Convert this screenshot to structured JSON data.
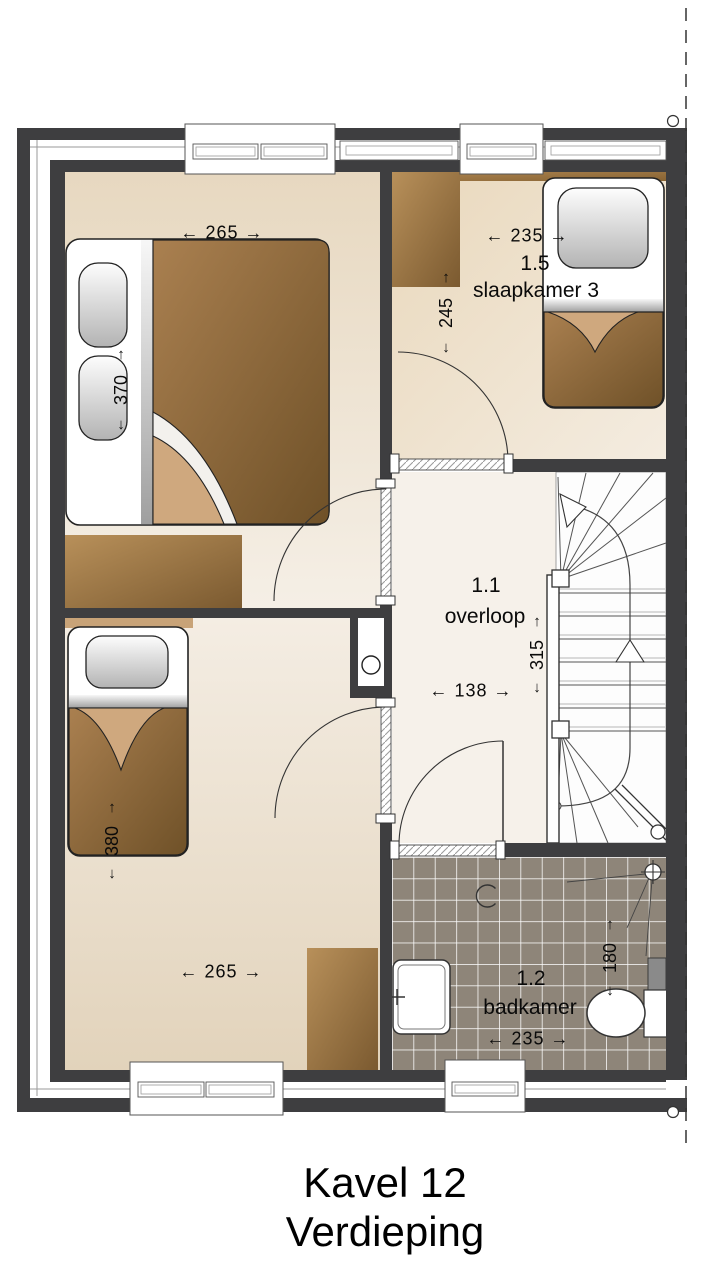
{
  "title": {
    "line1": "Kavel 12",
    "line2": "Verdieping"
  },
  "rooms": {
    "slaapkamer3": {
      "code": "1.5",
      "name": "slaapkamer 3"
    },
    "overloop": {
      "code": "1.1",
      "name": "overloop"
    },
    "badkamer": {
      "code": "1.2",
      "name": "badkamer"
    }
  },
  "dims": {
    "bedroom1_width": "← 265 →",
    "bedroom1_depth": "370",
    "hall_depth": "245",
    "slaapkamer3_width": "← 235 →",
    "overloop_width": "← 138 →",
    "stair_depth": "315",
    "bedroom2_depth": "380",
    "bedroom2_width": "← 265 →",
    "badkamer_width": "← 235 →",
    "badkamer_depth": "180",
    "arrow_up": "↑",
    "arrow_down": "↓"
  },
  "colors": {
    "wall": "#3e3e40",
    "tile": "#8e8579",
    "grout": "#ffffff",
    "floor_light": "#f5efe6",
    "floor_beige": "#e8d9c1",
    "overloop_floor": "#f6f1ea",
    "wood_light": "#b8905a",
    "wood_dark": "#7b5a30",
    "blanket_light": "#aa8050",
    "blanket_dark": "#6f5128",
    "fold": "#cfa87e",
    "line": "#333333"
  }
}
